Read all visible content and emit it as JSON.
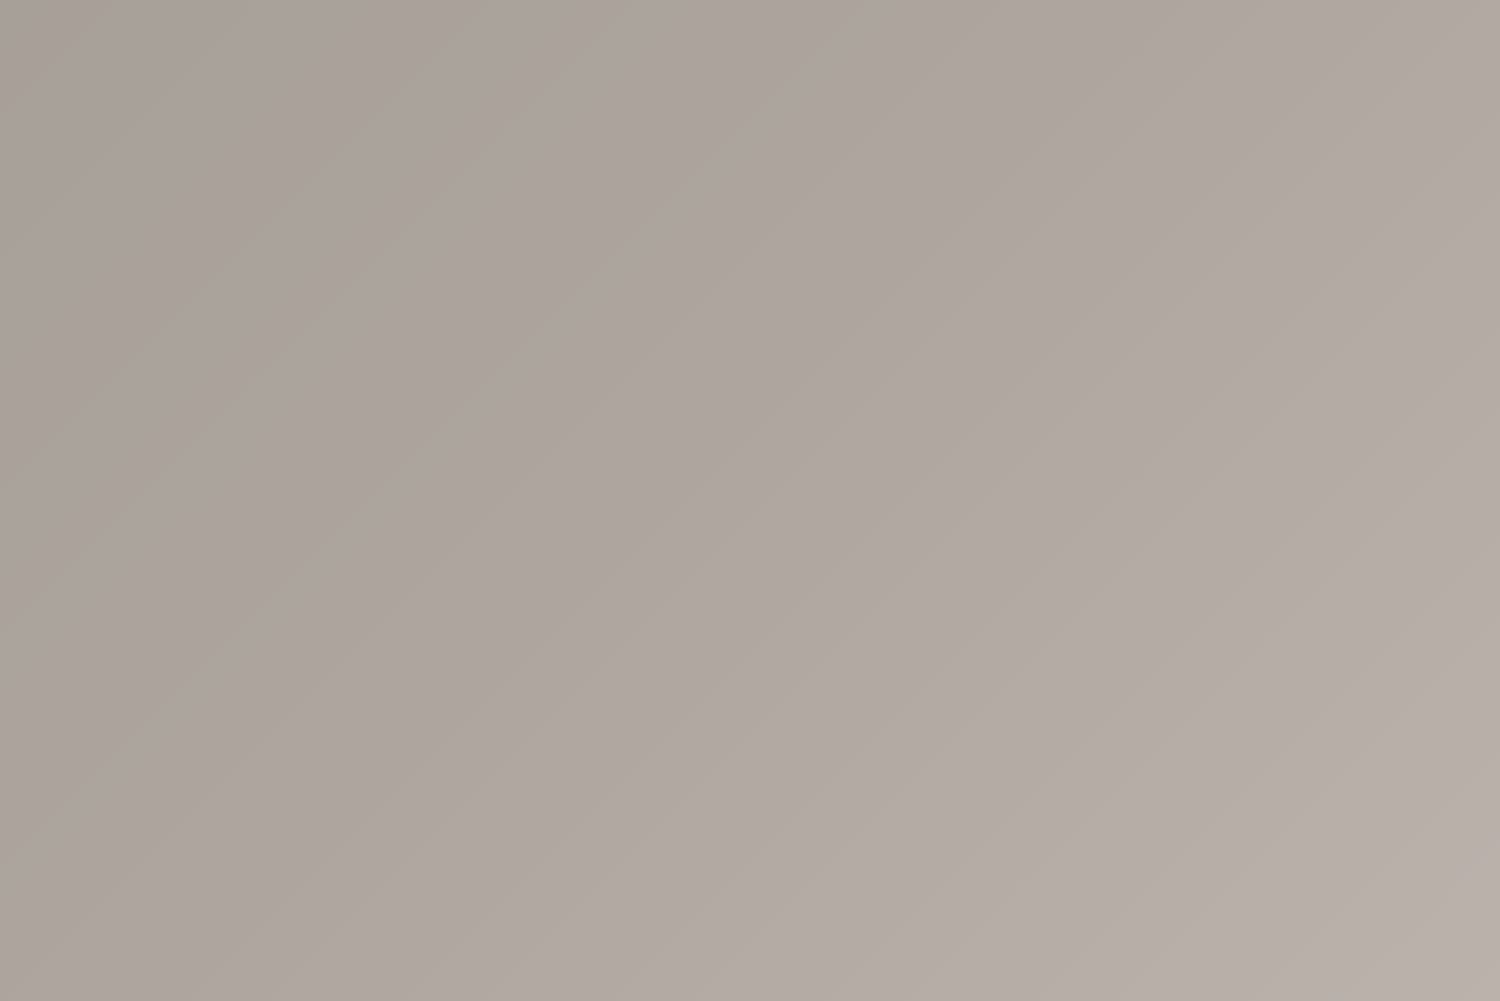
{
  "image": {
    "kind": "3D architectural rendering",
    "view": "aerial isometric view of a residential development",
    "alt": "Row of four modern two-storey terraced villas with roof terraces, corten balconies, stone-clad ground floors, private lawned gardens, swimming pools, wooden sun decks and a shared driveway, on a plain taupe background"
  },
  "watermark": {
    "text": "Alma Dom",
    "columns": 6,
    "rows": 4,
    "color": "rgba(255,255,255,0.52)",
    "grid": {
      "left": 83,
      "top": 110,
      "x_spacing": 245,
      "y_spacing": 245
    }
  },
  "scene": {
    "villas": 4,
    "pools": 4,
    "skylights_per_roof": 2,
    "sun_loungers_per_garden": 2,
    "roof_terraces": 4,
    "dividing_garden_walls": 3,
    "driveway_position": "lower left",
    "gardens_position": "lower right of each villa",
    "shadow_direction": "upper right"
  },
  "palette": {
    "background": "#aea69e",
    "roof": "#eae3d3",
    "roofLow": "#e1dac8",
    "parapet": "#f4efe2",
    "khaki": "#a89d7c",
    "khakiDark": "#8d8266",
    "khakiSide": "#b5a888",
    "stone": "#a69c8a",
    "opening": "#44453d",
    "corten": "#b06b3a",
    "cortenDark": "#8f5330",
    "pavement": "#ddd6c3",
    "wallTop": "#efe9da",
    "wallFace": "#d8d1be",
    "drive": "#e8e1d1",
    "soil": "#9a9177",
    "hedge": "#41582f",
    "lawn": "#85aa4a",
    "shrubLight": "#9ab05c",
    "shrubOlive": "#6f8f3e",
    "shrubGray": "#8a8a78",
    "deck": "#bf9765",
    "deckLight": "#ddd5c2",
    "lounger": "#eee4d1",
    "loungerBrown": "#9c6b40",
    "poolShallow": "#cfe7ec",
    "poolMid": "#7ec2dd",
    "poolDeep": "#4096c0",
    "poolRim": "#f0ead9",
    "skylight": "#4b5863",
    "table": "#8a6a40",
    "chair": "#6e5433",
    "shadow": "#5f7085",
    "watermarkColor": "rgba(255,255,255,0.52)"
  }
}
